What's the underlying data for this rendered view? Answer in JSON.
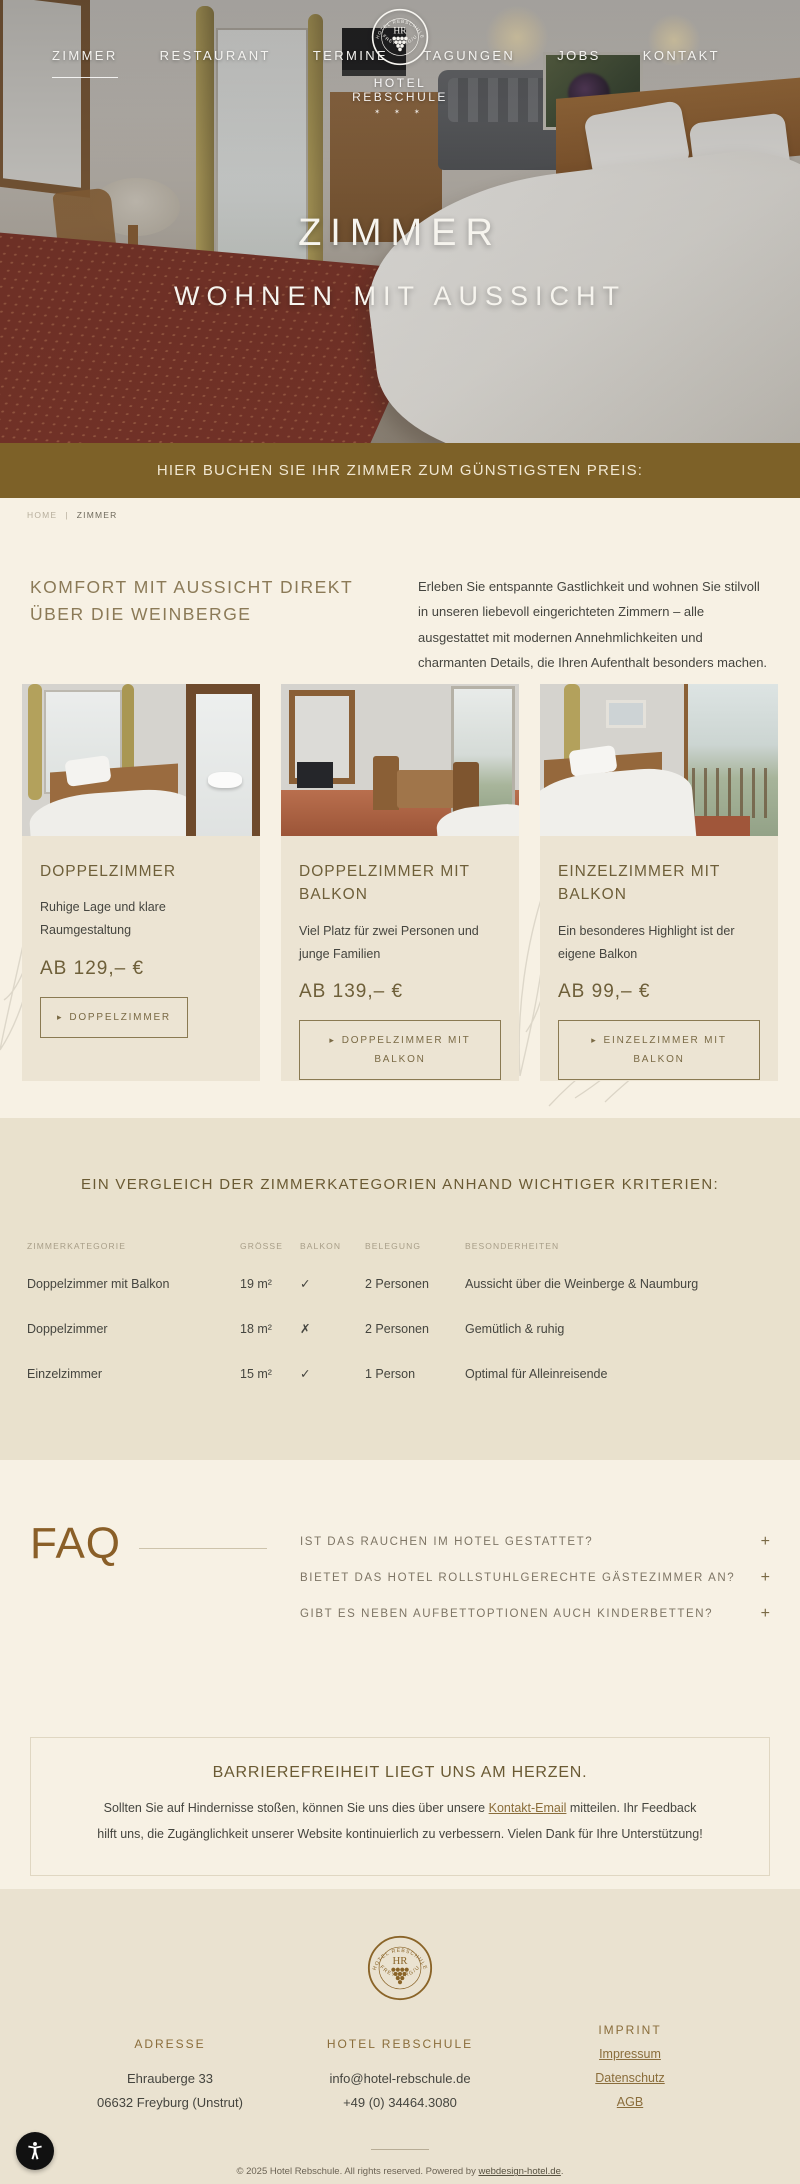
{
  "logo": {
    "initials": "HR",
    "ring_top": "HOTEL REBSCHULE",
    "ring_bottom": "· FREYBURG/U ·",
    "name": "HOTEL REBSCHULE",
    "stars": "✶ ✶ ✶"
  },
  "nav": {
    "left": [
      {
        "label": "ZIMMER"
      },
      {
        "label": "RESTAURANT"
      },
      {
        "label": "TERMINE"
      }
    ],
    "right": [
      {
        "label": "TAGUNGEN"
      },
      {
        "label": "JOBS"
      },
      {
        "label": "KONTAKT"
      }
    ]
  },
  "hero": {
    "title": "ZIMMER",
    "subtitle": "WOHNEN MIT AUSSICHT"
  },
  "banner": {
    "text": "HIER BUCHEN SIE IHR ZIMMER ZUM GÜNSTIGSTEN PREIS:"
  },
  "breadcrumb": {
    "home": "HOME",
    "separator": "|",
    "current": "ZIMMER"
  },
  "intro": {
    "heading": "KOMFORT MIT AUSSICHT DIREKT ÜBER DIE WEINBERGE",
    "text": "Erleben Sie entspannte Gastlichkeit und wohnen Sie stilvoll in unseren liebevoll eingerichteten Zimmern – alle ausgestattet mit modernen Annehmlichkeiten und charmanten Details, die Ihren Aufenthalt besonders machen."
  },
  "rooms": [
    {
      "title": "DOPPELZIMMER",
      "description": "Ruhige Lage und klare Raumgestaltung",
      "price": "AB 129,– €",
      "button": "DOPPELZIMMER"
    },
    {
      "title": "DOPPELZIMMER MIT BALKON",
      "description": "Viel Platz für zwei Personen und junge Familien",
      "price": "AB 139,– €",
      "button": "DOPPELZIMMER MIT BALKON"
    },
    {
      "title": "EINZELZIMMER MIT BALKON",
      "description": "Ein besonderes Highlight ist der eigene Balkon",
      "price": "AB 99,– €",
      "button": "EINZELZIMMER MIT BALKON"
    }
  ],
  "comparison": {
    "heading": "EIN VERGLEICH DER ZIMMERKATEGORIEN ANHAND WICHTIGER KRITERIEN:",
    "columns": [
      "ZIMMERKATEGORIE",
      "GRÖSSE",
      "BALKON",
      "BELEGUNG",
      "BESONDERHEITEN"
    ],
    "rows": [
      {
        "kategorie": "Doppelzimmer mit Balkon",
        "groesse": "19 m²",
        "balkon": "✓",
        "belegung": "2 Personen",
        "besonderheiten": "Aussicht über die Weinberge & Naumburg"
      },
      {
        "kategorie": "Doppelzimmer",
        "groesse": "18 m²",
        "balkon": "✗",
        "belegung": "2 Personen",
        "besonderheiten": "Gemütlich & ruhig"
      },
      {
        "kategorie": "Einzelzimmer",
        "groesse": "15 m²",
        "balkon": "✓",
        "belegung": "1 Person",
        "besonderheiten": "Optimal für Alleinreisende"
      }
    ]
  },
  "faq": {
    "heading": "FAQ",
    "items": [
      {
        "question": "IST DAS RAUCHEN IM HOTEL GESTATTET?"
      },
      {
        "question": "BIETET DAS HOTEL ROLLSTUHLGERECHTE GÄSTEZIMMER AN?"
      },
      {
        "question": "GIBT ES NEBEN AUFBETTOPTIONEN AUCH KINDERBETTEN?"
      }
    ]
  },
  "note": {
    "heading": "BARRIEREFREIHEIT LIEGT UNS AM HERZEN.",
    "text_before": "Sollten Sie auf Hindernisse stoßen, können Sie uns dies über unsere ",
    "link": "Kontakt-Email",
    "text_after": " mitteilen. Ihr Feedback hilft uns, die Zugänglichkeit unserer Website kontinuierlich zu verbessern. Vielen Dank für Ihre Unterstützung!"
  },
  "footer": {
    "address": {
      "heading": "ADRESSE",
      "line1": "Ehrauberge 33",
      "line2": "06632 Freyburg (Unstrut)"
    },
    "contact": {
      "heading": "HOTEL REBSCHULE",
      "email": "info@hotel-rebschule.de",
      "phone": "+49 (0) 34464.3080"
    },
    "imprint": {
      "heading": "IMPRINT",
      "links": [
        "Impressum",
        "Datenschutz",
        "AGB"
      ]
    },
    "copyright": {
      "text_before": "© 2025 Hotel Rebschule. All rights reserved. Powered by ",
      "link": "webdesign-hotel.de",
      "text_after": "."
    }
  },
  "icons": {
    "arrow": "▸",
    "plus": "+"
  },
  "colors": {
    "banner_brown": "#7d6128",
    "heading_brown": "#8b7a57",
    "accent_brown": "#8a6d3b",
    "page_bg": "#f7f1e4",
    "card_bg": "#ece4d3",
    "section_bg": "#e9e1cd",
    "footer_bg": "#eae2d0"
  }
}
